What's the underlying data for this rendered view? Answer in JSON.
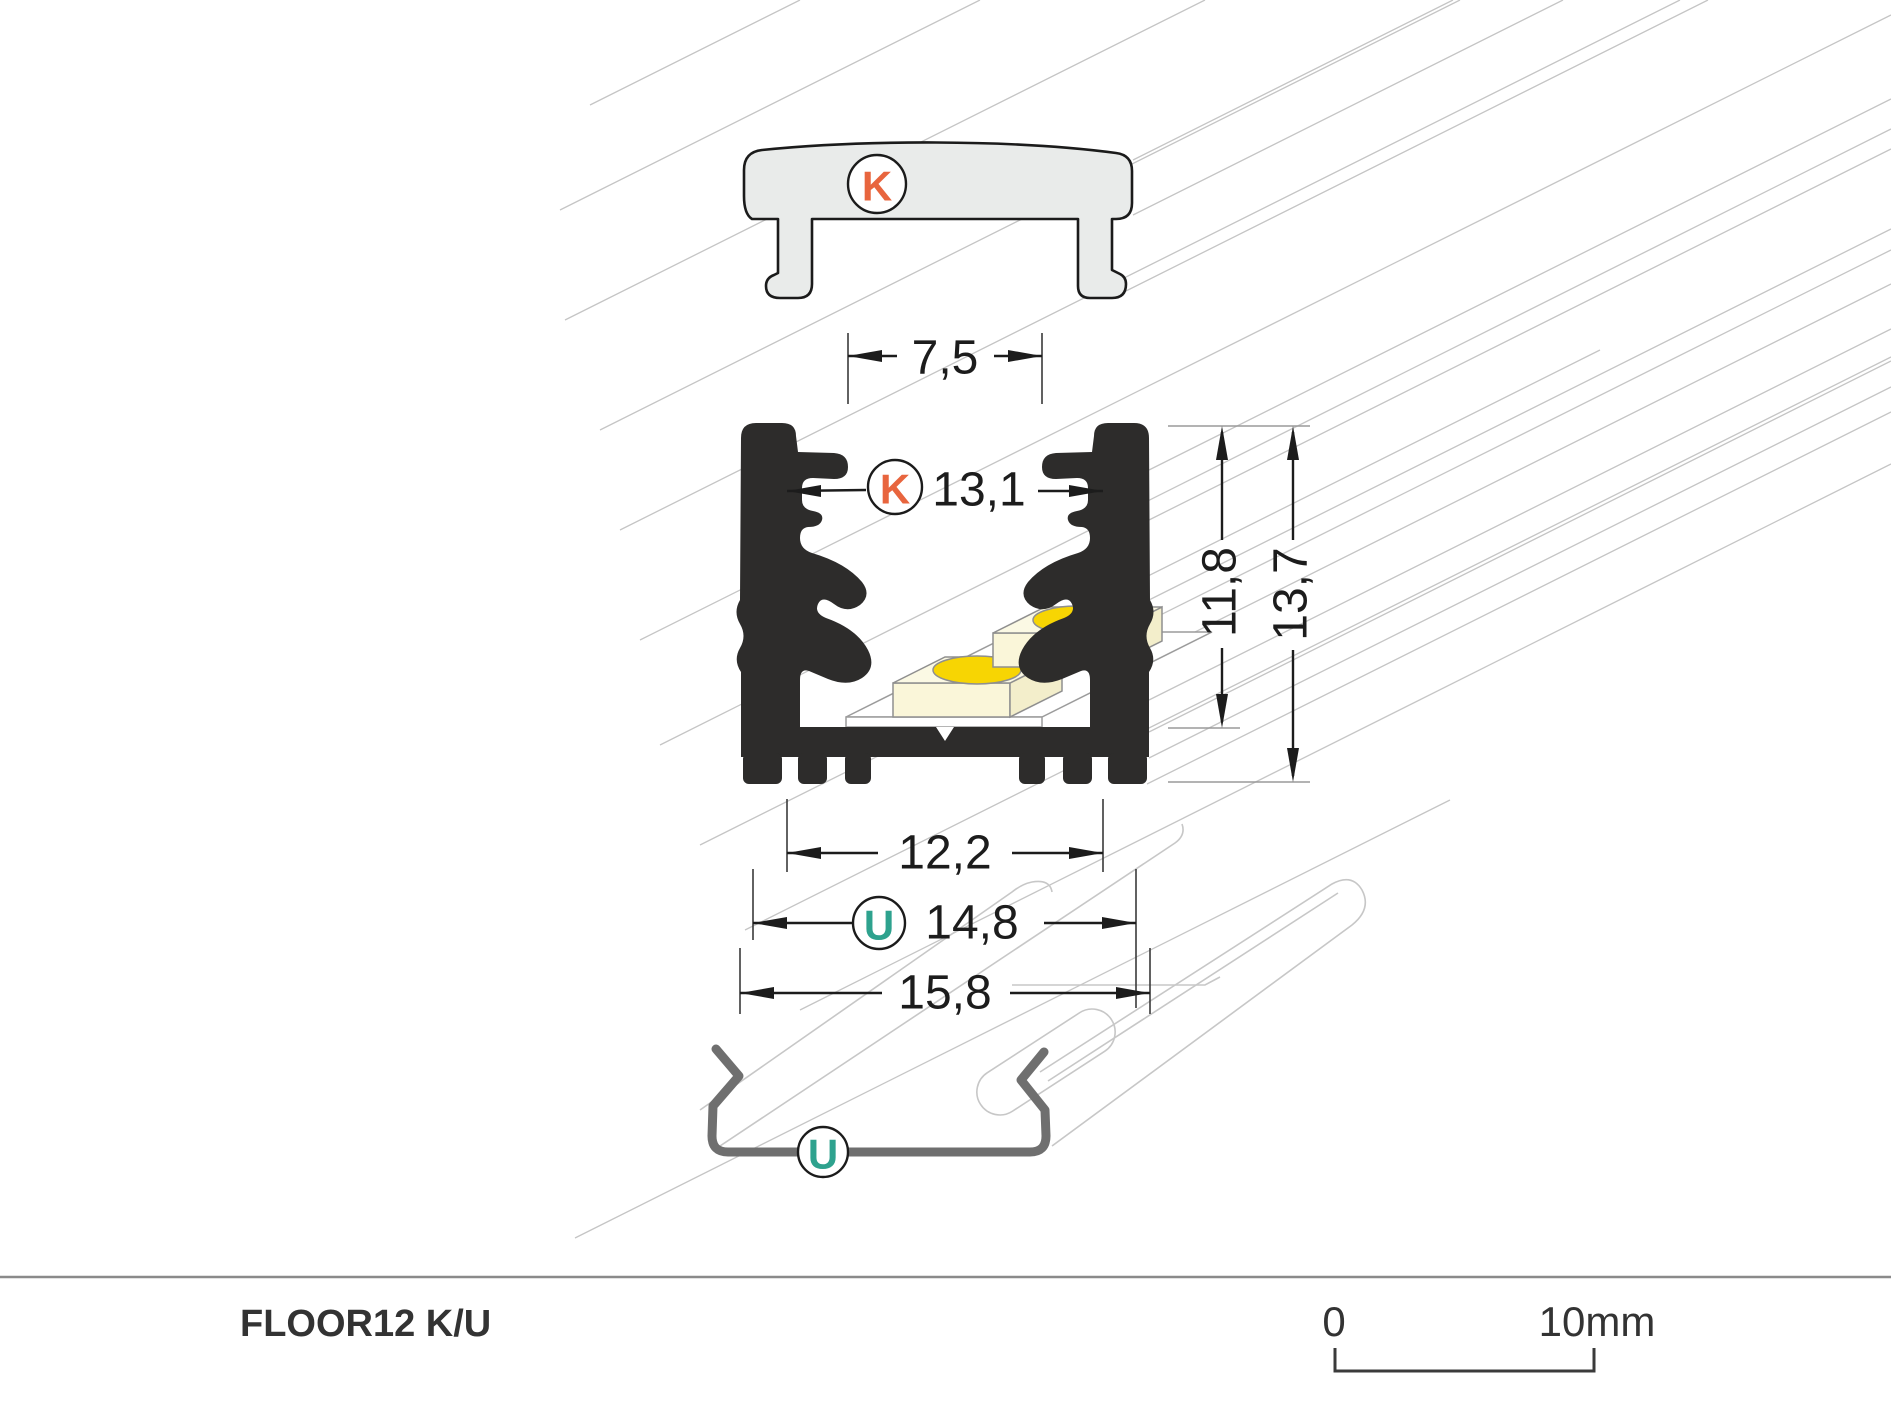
{
  "diagram": {
    "product_name": "FLOOR12 K/U",
    "scale_bar": {
      "start": "0",
      "end": "10mm"
    },
    "cover": {
      "label": "K"
    },
    "clip": {
      "label": "U"
    },
    "profile": {
      "slot_width": "7,5",
      "cover_width": "13,1",
      "inner_height": "11,8",
      "outer_height": "13,7",
      "inner_width": "12,2",
      "outer_width": "14,8",
      "base_width": "15,8"
    },
    "colors": {
      "k_label": "#E8653E",
      "u_label": "#2EA28E",
      "profile_fill": "#2D2C2B",
      "cover_fill": "#E9EBEA",
      "led_chip": "#F7D503",
      "led_module": "#FAF6D9",
      "led_module_top": "#FBF9E4",
      "led_module_side": "#F3EECB",
      "hatch": "#C5C5C5",
      "clip_stroke": "#6F6F6F",
      "dimension_ink": "#1C1C1C",
      "footer_rule": "#8A8A8A"
    }
  }
}
